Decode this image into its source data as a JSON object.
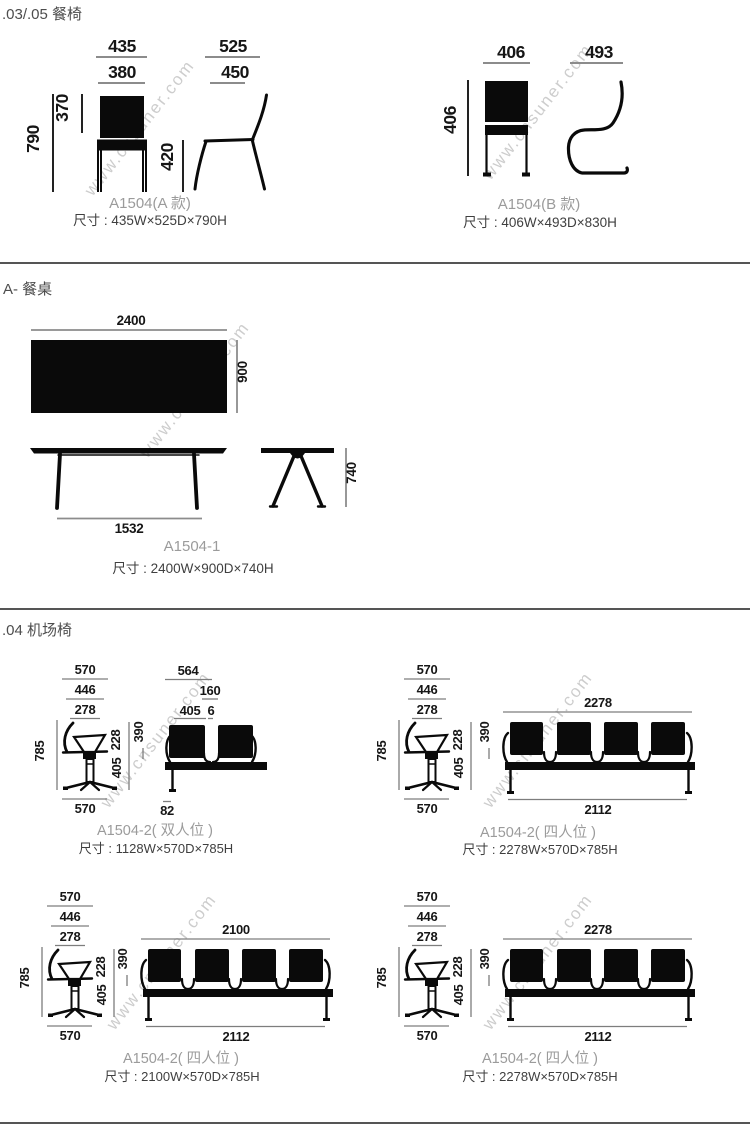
{
  "watermark": "www.cnsuner.com",
  "s1": {
    "title": ".03/.05 餐椅",
    "a": {
      "name": "A1504(A 款)",
      "size": "尺寸 : 435W×525D×790H",
      "w_outer": "435",
      "w_inner": "380",
      "back_h": "370",
      "total_h": "790",
      "seat_h": "420",
      "d_outer": "525",
      "d_inner": "450"
    },
    "b": {
      "name": "A1504(B 款)",
      "size": "尺寸 : 406W×493D×830H",
      "w": "406",
      "h": "406",
      "d": "493"
    }
  },
  "s2": {
    "title": "A- 餐桌",
    "t": {
      "name": "A1504-1",
      "size": "尺寸 : 2400W×900D×740H",
      "w": "2400",
      "d": "900",
      "leg_span": "1532",
      "h": "740"
    }
  },
  "s3": {
    "title": ".04 机场椅",
    "side": {
      "w1": "570",
      "w2": "446",
      "w3": "278",
      "h": "785",
      "back": "228",
      "under": "405",
      "wb": "570"
    },
    "u1": {
      "name": "A1504-2( 双人位 )",
      "size": "尺寸 : 1128W×570D×785H",
      "pitch": "564",
      "t2": "160",
      "t3": "405",
      "gap": "6",
      "seat": "390",
      "foot": "82"
    },
    "u2": {
      "name": "A1504-2( 四人位 )",
      "size": "尺寸 : 2278W×570D×785H",
      "top": "2278",
      "seat": "390",
      "bottom": "2112"
    },
    "u3": {
      "name": "A1504-2( 四人位 )",
      "size": "尺寸 : 2100W×570D×785H",
      "top": "2100",
      "seat": "390",
      "bottom": "2112"
    },
    "u4": {
      "name": "A1504-2( 四人位 )",
      "size": "尺寸 : 2278W×570D×785H",
      "top": "2278",
      "seat": "390",
      "bottom": "2112"
    }
  }
}
